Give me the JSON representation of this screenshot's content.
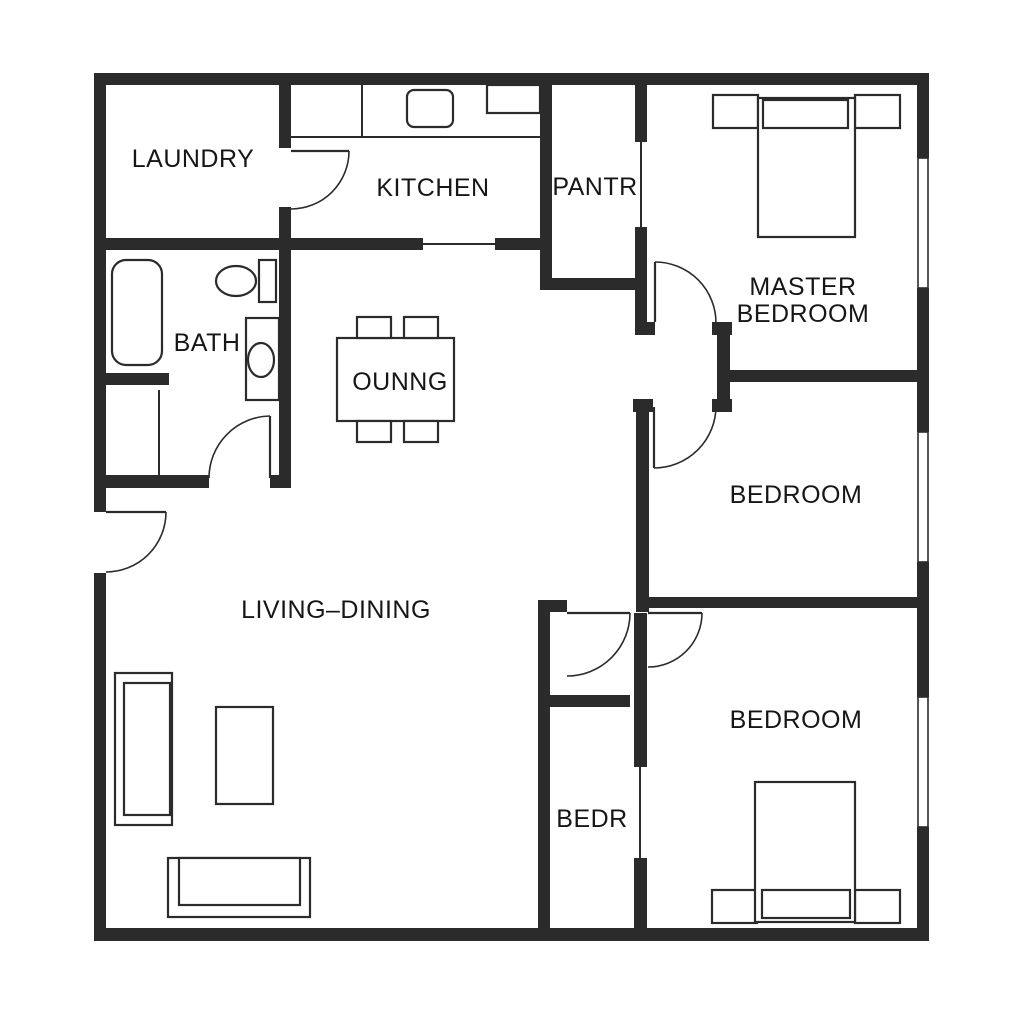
{
  "plan": {
    "type": "floor-plan",
    "colors": {
      "wall": "#2b2b2b",
      "line": "#2b2b2b",
      "background": "#ffffff",
      "text": "#161616"
    },
    "labels": [
      {
        "id": "laundry",
        "text": "LAUNDRY",
        "x": 193,
        "y": 167
      },
      {
        "id": "kitchen",
        "text": "KITCHEN",
        "x": 433,
        "y": 196
      },
      {
        "id": "pantry",
        "text": "PANTR",
        "x": 595,
        "y": 195
      },
      {
        "id": "master-line1",
        "text": "MASTER",
        "x": 803,
        "y": 295
      },
      {
        "id": "master-line2",
        "text": "BEDROOM",
        "x": 803,
        "y": 322
      },
      {
        "id": "bath",
        "text": "BATH",
        "x": 207,
        "y": 351
      },
      {
        "id": "dining-nook",
        "text": "OUNNG",
        "x": 400,
        "y": 390
      },
      {
        "id": "bedroom-middle",
        "text": "BEDROOM",
        "x": 796,
        "y": 503
      },
      {
        "id": "living-dining",
        "text": "LIVING–DINING",
        "x": 336,
        "y": 618
      },
      {
        "id": "bedroom-bottom",
        "text": "BEDROOM",
        "x": 796,
        "y": 728
      },
      {
        "id": "bedr",
        "text": "BEDR",
        "x": 592,
        "y": 827
      }
    ],
    "walls": [
      [
        94,
        73,
        835,
        12
      ],
      [
        94,
        928,
        835,
        13
      ],
      [
        94,
        73,
        12,
        439
      ],
      [
        94,
        573,
        12,
        360
      ],
      [
        917,
        85,
        12,
        73
      ],
      [
        917,
        288,
        12,
        144
      ],
      [
        917,
        562,
        12,
        135
      ],
      [
        917,
        827,
        12,
        104
      ],
      [
        279,
        85,
        12,
        63
      ],
      [
        279,
        207,
        12,
        280
      ],
      [
        94,
        238,
        329,
        12
      ],
      [
        495,
        238,
        57,
        12
      ],
      [
        540,
        85,
        12,
        202
      ],
      [
        540,
        278,
        103,
        12
      ],
      [
        635,
        85,
        12,
        57
      ],
      [
        635,
        227,
        12,
        95
      ],
      [
        635,
        322,
        20,
        13
      ],
      [
        717,
        322,
        13,
        90
      ],
      [
        712,
        322,
        20,
        13
      ],
      [
        712,
        399,
        20,
        13
      ],
      [
        717,
        370,
        212,
        12
      ],
      [
        633,
        399,
        20,
        13
      ],
      [
        636,
        412,
        13,
        200
      ],
      [
        638,
        597,
        279,
        11
      ],
      [
        538,
        600,
        29,
        12
      ],
      [
        538,
        600,
        12,
        330
      ],
      [
        540,
        695,
        90,
        12
      ],
      [
        634,
        613,
        13,
        154
      ],
      [
        634,
        858,
        13,
        72
      ],
      [
        94,
        373,
        75,
        12
      ],
      [
        94,
        475,
        115,
        13
      ],
      [
        270,
        475,
        21,
        13
      ]
    ],
    "thin_lines": [
      {
        "name": "kitchen-opening-line",
        "pts": [
          423,
          244,
          495,
          244
        ]
      },
      {
        "name": "pantry-opening-line",
        "pts": [
          641,
          142,
          641,
          227
        ]
      },
      {
        "name": "bedr-opening-line",
        "pts": [
          640,
          767,
          640,
          858
        ]
      },
      {
        "name": "bath-closet-line",
        "pts": [
          159,
          390,
          159,
          477
        ]
      },
      {
        "name": "kitchen-counter-edge",
        "pts": [
          291,
          137,
          540,
          137
        ]
      },
      {
        "name": "kitchen-counter-divider",
        "pts": [
          362,
          85,
          362,
          137
        ]
      }
    ],
    "doors": [
      {
        "id": "entry-door",
        "leaf": [
          106,
          512,
          166,
          512
        ],
        "arc": "M 166 512 A 60 60 0 0 1 106 572"
      },
      {
        "id": "laundry-door",
        "leaf": [
          291,
          151,
          349,
          151
        ],
        "arc": "M 349 151 A 58 58 0 0 1 291 209"
      },
      {
        "id": "bath-door",
        "leaf": [
          270,
          478,
          270,
          416
        ],
        "arc": "M 209 478 A 62 62 0 0 1 270 416"
      },
      {
        "id": "master-bedroom-door",
        "leaf": [
          655,
          262,
          655,
          322
        ],
        "arc": "M 655 262 A 61 61 0 0 1 716 323"
      },
      {
        "id": "middle-bedroom-door",
        "leaf": [
          654,
          407,
          654,
          468
        ],
        "arc": "M 654 468 A 62 62 0 0 0 716 406"
      },
      {
        "id": "vestibule-door",
        "leaf": [
          567,
          613,
          630,
          613
        ],
        "arc": "M 630 613 A 63 63 0 0 1 567 676"
      },
      {
        "id": "bottom-bedroom-door",
        "leaf": [
          648,
          613,
          702,
          613
        ],
        "arc": "M 702 613 A 54 54 0 0 1 648 667"
      }
    ],
    "windows": [
      [
        918,
        158,
        10,
        130
      ],
      [
        918,
        432,
        10,
        130
      ],
      [
        918,
        697,
        10,
        130
      ]
    ],
    "furniture": {
      "rects": [
        {
          "name": "kitchen-appliance",
          "x": 487,
          "y": 85,
          "w": 53,
          "h": 28
        },
        {
          "name": "toilet-tank",
          "x": 259,
          "y": 260,
          "w": 17,
          "h": 42
        },
        {
          "name": "bath-vanity",
          "x": 246,
          "y": 318,
          "w": 33,
          "h": 82
        },
        {
          "name": "dining-table",
          "x": 337,
          "y": 338,
          "w": 117,
          "h": 83
        },
        {
          "name": "dining-chair",
          "x": 357,
          "y": 317,
          "w": 34,
          "h": 21
        },
        {
          "name": "dining-chair",
          "x": 404,
          "y": 317,
          "w": 34,
          "h": 21
        },
        {
          "name": "dining-chair",
          "x": 357,
          "y": 421,
          "w": 34,
          "h": 21
        },
        {
          "name": "dining-chair",
          "x": 404,
          "y": 421,
          "w": 34,
          "h": 21
        },
        {
          "name": "sofa-vertical-outer",
          "x": 115,
          "y": 673,
          "w": 57,
          "h": 152
        },
        {
          "name": "sofa-vertical-inner",
          "x": 124,
          "y": 683,
          "w": 46,
          "h": 132
        },
        {
          "name": "armchair",
          "x": 216,
          "y": 707,
          "w": 57,
          "h": 97
        },
        {
          "name": "sofa-horizontal-outer",
          "x": 168,
          "y": 858,
          "w": 142,
          "h": 59
        },
        {
          "name": "sofa-horizontal-inner",
          "x": 179,
          "y": 858,
          "w": 121,
          "h": 47
        },
        {
          "name": "nightstand",
          "x": 713,
          "y": 95,
          "w": 45,
          "h": 33
        },
        {
          "name": "nightstand",
          "x": 855,
          "y": 95,
          "w": 45,
          "h": 33
        },
        {
          "name": "master-bed",
          "x": 758,
          "y": 98,
          "w": 97,
          "h": 139
        },
        {
          "name": "master-headboard",
          "x": 763,
          "y": 100,
          "w": 85,
          "h": 28
        },
        {
          "name": "nightstand",
          "x": 712,
          "y": 890,
          "w": 45,
          "h": 33
        },
        {
          "name": "nightstand",
          "x": 855,
          "y": 890,
          "w": 45,
          "h": 33
        },
        {
          "name": "bottom-bed",
          "x": 755,
          "y": 782,
          "w": 100,
          "h": 140
        },
        {
          "name": "bottom-headboard",
          "x": 762,
          "y": 890,
          "w": 88,
          "h": 28
        }
      ],
      "rounded": [
        {
          "name": "bathtub",
          "x": 112,
          "y": 260,
          "w": 50,
          "h": 105,
          "r": 14
        },
        {
          "name": "kitchen-stove",
          "x": 407,
          "y": 90,
          "w": 46,
          "h": 37,
          "r": 7
        }
      ],
      "ellipses": [
        {
          "name": "toilet-bowl",
          "cx": 236,
          "cy": 281,
          "rx": 20,
          "ry": 15
        },
        {
          "name": "bath-sink",
          "cx": 261,
          "cy": 360,
          "rx": 13,
          "ry": 17
        }
      ]
    }
  }
}
